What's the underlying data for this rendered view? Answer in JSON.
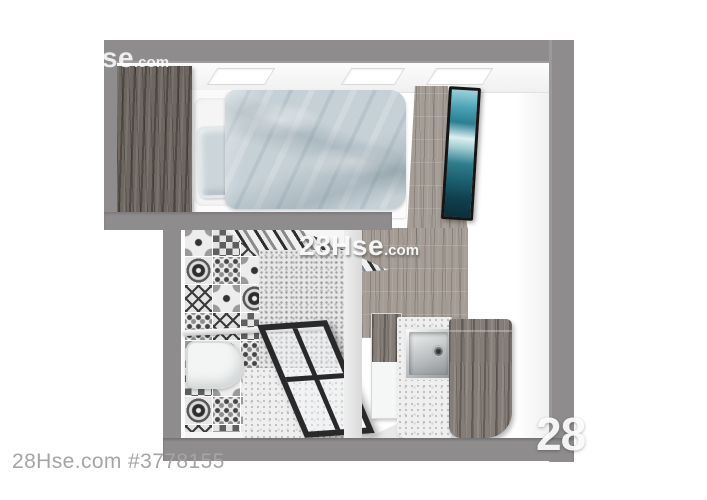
{
  "caption": {
    "text": "28Hse.com #3778155"
  },
  "watermarks": {
    "top_left": {
      "brand": "28Hse",
      "suffix": ".com"
    },
    "center": {
      "brand": "28Hse",
      "suffix": ".com"
    },
    "bottom_right": {
      "text": "28"
    }
  },
  "palette": {
    "wall": "#8e8c8d",
    "wood-dark": "#6d6661",
    "wood-mid": "#857d77",
    "wood-light": "#a49c95",
    "duvet": "#c6d1d7",
    "pillow": "#ccd6da",
    "tub": "#f3f4f4",
    "steel": "#989c9e",
    "tv-teal": "#2e7d8c"
  }
}
